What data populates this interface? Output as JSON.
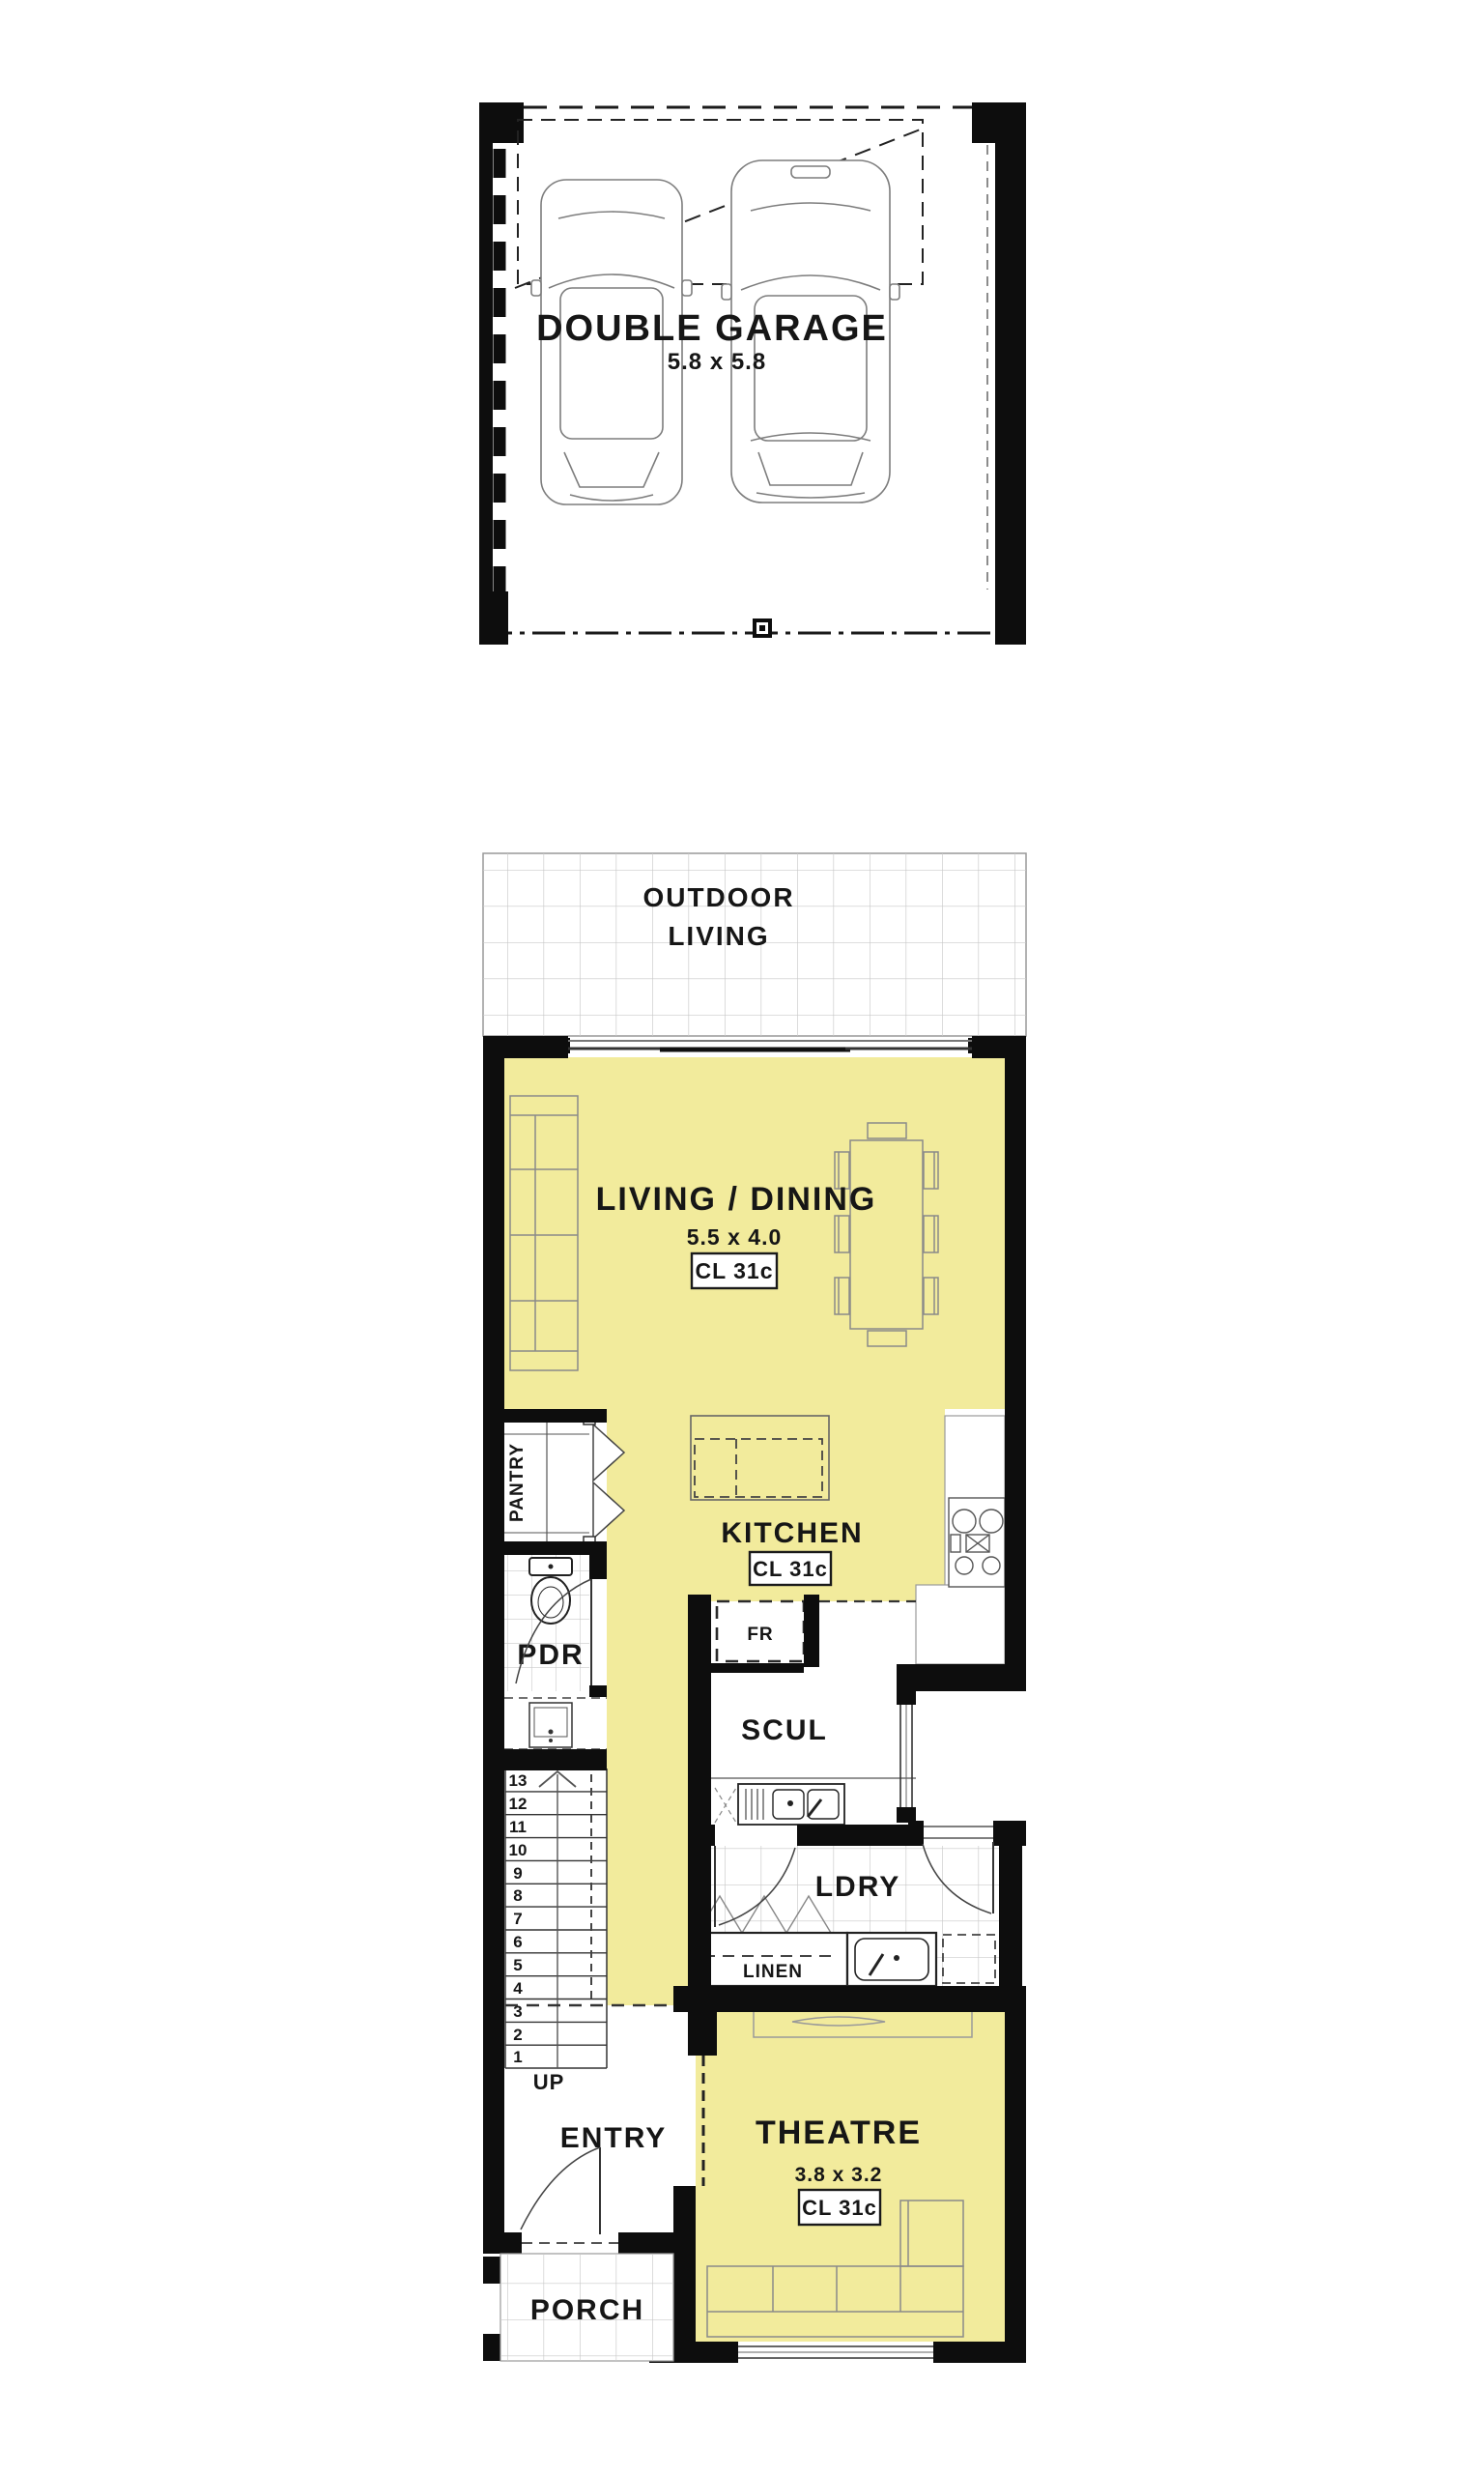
{
  "meta": {
    "type": "architectural-floor-plan",
    "background": "#ffffff"
  },
  "colors": {
    "room_fill_yellow": "#F2EB9C",
    "wall_black": "#0d0d0d",
    "tile_line": "#c9c9c9",
    "furniture_line": "#8a8a8a",
    "text": "#161616",
    "label_box_bg": "#ffffff"
  },
  "garage": {
    "label": "DOUBLE GARAGE",
    "dims": "5.8 x 5.8"
  },
  "outdoor_living": {
    "line1": "OUTDOOR",
    "line2": "LIVING"
  },
  "living_dining": {
    "label": "LIVING / DINING",
    "dims": "5.5 x 4.0",
    "ceiling": "CL 31c"
  },
  "kitchen": {
    "label": "KITCHEN",
    "ceiling": "CL 31c",
    "fridge": "FR"
  },
  "pantry": {
    "label": "PANTRY"
  },
  "powder_room": {
    "label": "PDR"
  },
  "scullery": {
    "label": "SCUL"
  },
  "laundry": {
    "label": "LDRY",
    "linen": "LINEN"
  },
  "stairs": {
    "up": "UP",
    "numbers": [
      "13",
      "12",
      "11",
      "10",
      "9",
      "8",
      "7",
      "6",
      "5",
      "4",
      "3",
      "2",
      "1"
    ]
  },
  "entry": {
    "label": "ENTRY"
  },
  "theatre": {
    "label": "THEATRE",
    "dims": "3.8 x 3.2",
    "ceiling": "CL 31c"
  },
  "porch": {
    "label": "PORCH"
  }
}
